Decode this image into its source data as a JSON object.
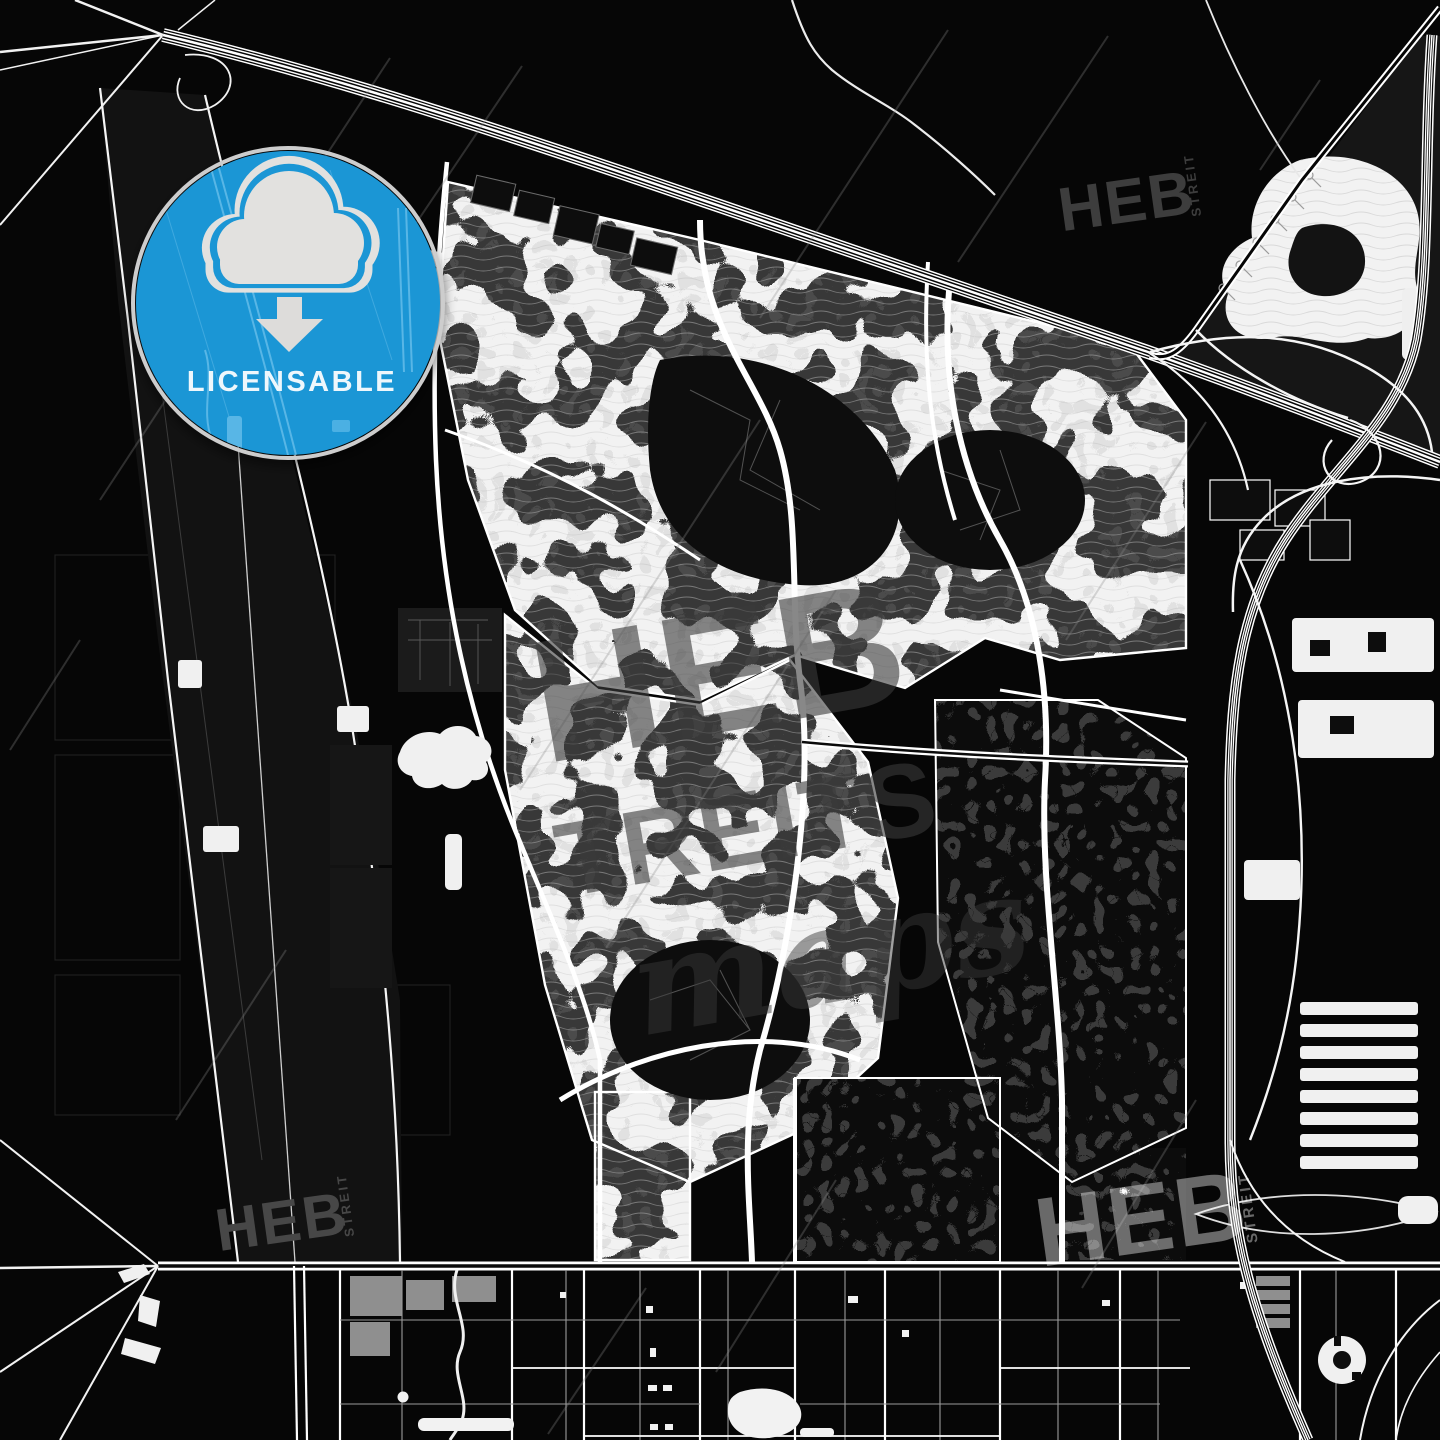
{
  "page": {
    "kind": "dark-map-preview",
    "width": 1440,
    "height": 1440,
    "background": "#060606"
  },
  "badge": {
    "label": "LICENSABLE",
    "icon": "cloud-download",
    "circle_color": "#1b96d5",
    "ring_color": "#cdcdcd",
    "icon_color": "#e2e1df",
    "label_color": "#eef7fc"
  },
  "watermarks": {
    "brand_main": "HEB",
    "brand_sub": "STREIT",
    "center_line1": "HEB",
    "center_line2": "TREITS",
    "center_script": "maps",
    "dark_color": "#3f3f3f",
    "light_color": "rgba(255,255,255,0.40)"
  },
  "map": {
    "road_color": "#ffffff",
    "land_color": "#f2f2f2",
    "dark_color": "#0b0b0b",
    "water_highlight": "#58b6e6"
  }
}
